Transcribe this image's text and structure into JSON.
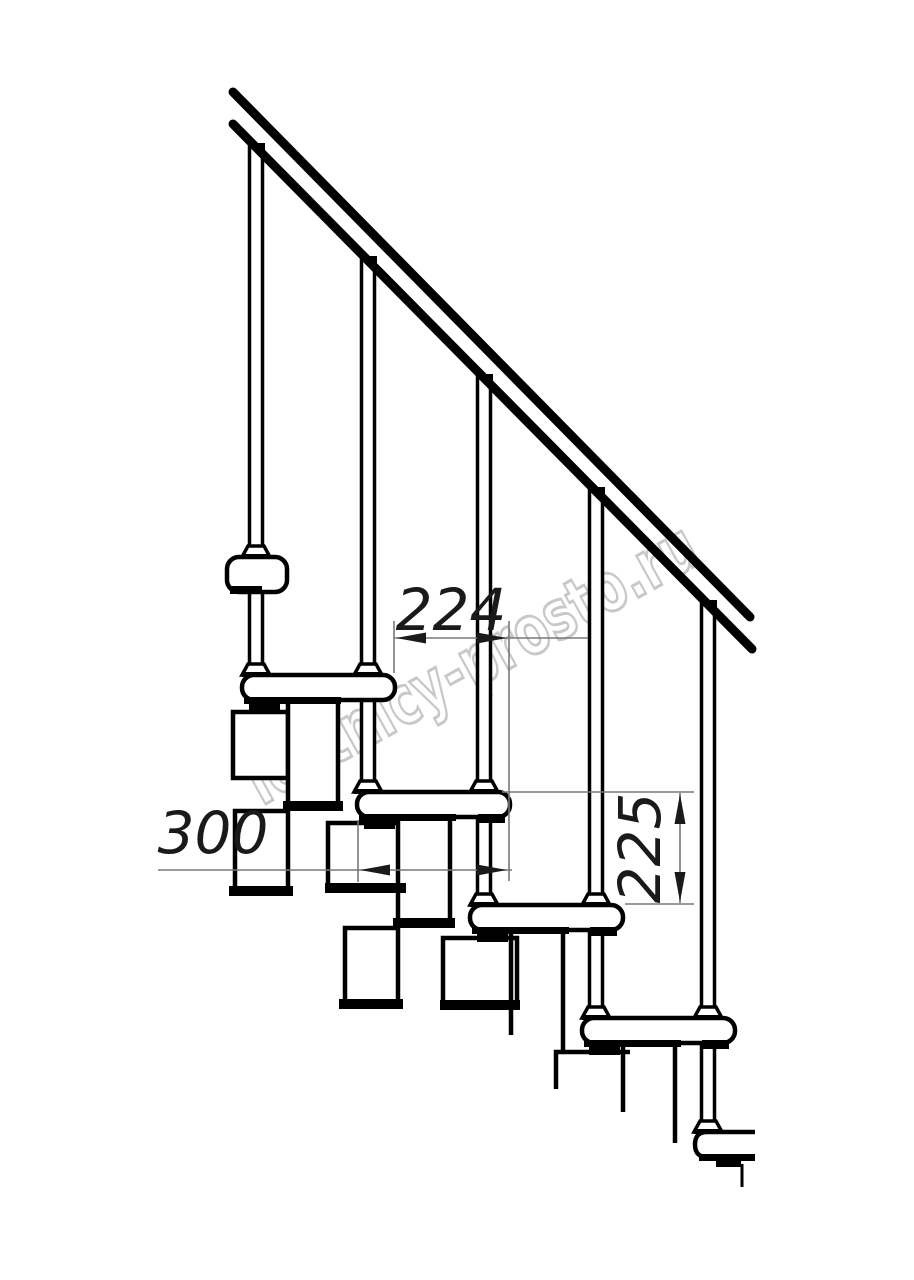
{
  "figure": {
    "type": "technical-line-drawing",
    "subject": "modular staircase side elevation with handrail, balusters, treads and support modules"
  },
  "dimensions": {
    "tread_run": "224",
    "tread_depth": "300",
    "riser_height": "225"
  },
  "watermark": {
    "text": "lestnicy-prosto.ru"
  },
  "colors": {
    "line": "#000000",
    "dim_line": "#787878",
    "dim_text": "#1a1a1a",
    "watermark": "#c8c8c8",
    "background": "#ffffff"
  }
}
